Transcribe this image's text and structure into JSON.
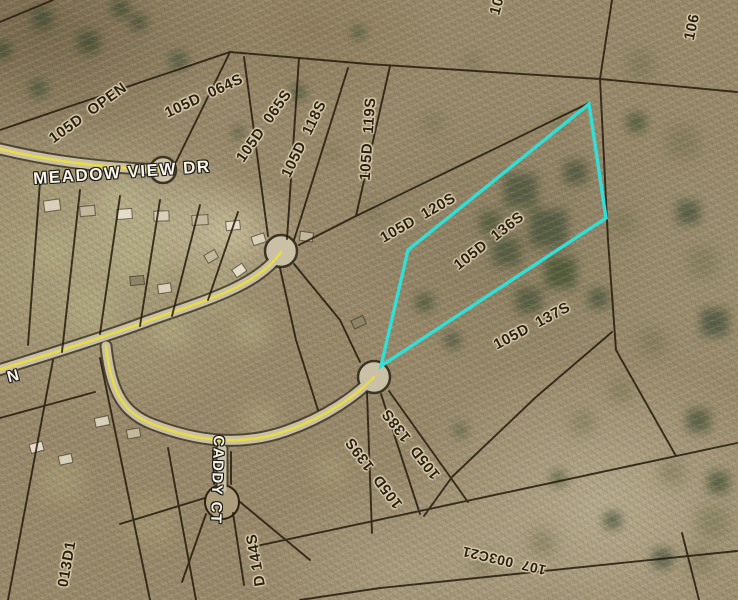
{
  "map": {
    "highlight_color": "#30dfd8",
    "road_centerline_color": "#eadd3f",
    "parcel_line_color": "#241a0c",
    "highlighted_parcel": "105D 136S",
    "street_labels": {
      "meadow_view_dr": "MEADOW VIEW DR",
      "caddy_ct": "CADDY CT",
      "partial_street_n": "N"
    },
    "parcel_labels": {
      "open": "105D  OPEN",
      "p064s": "105D  064S",
      "p065s": "105D  065S",
      "p118s": "105D  118S",
      "p119s": "105D  119S",
      "p120s": "105D  120S",
      "p136s": "105D  136S",
      "p137s": "105D  137S",
      "p138s": "105D  138S",
      "p139s": "105D  139S",
      "p144s_partial": "D 144S",
      "p106": "106",
      "p10_partial": "10",
      "p013d1_partial": "013D1",
      "p107_003c21": "107  003C21"
    }
  }
}
